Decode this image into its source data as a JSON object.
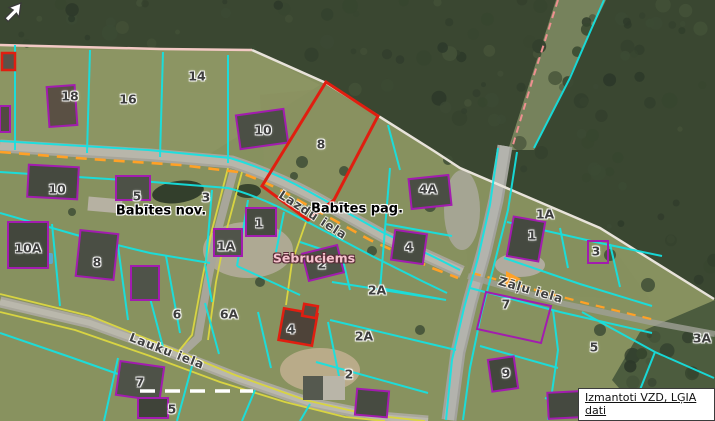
{
  "map": {
    "region_labels": {
      "municipality": "Babītes nov.",
      "parish": "Babītes pag.",
      "village": "Sēbruciems"
    },
    "streets": [
      {
        "name": "Lazdu iela"
      },
      {
        "name": "Zāļu iela"
      },
      {
        "name": "Lauku iela"
      }
    ],
    "parcels": [
      {
        "label": "18"
      },
      {
        "label": "16"
      },
      {
        "label": "14"
      },
      {
        "label": "10"
      },
      {
        "label": "8"
      },
      {
        "label": "10"
      },
      {
        "label": "5"
      },
      {
        "label": "3"
      },
      {
        "label": "4A"
      },
      {
        "label": "1A"
      },
      {
        "label": "10A"
      },
      {
        "label": "8"
      },
      {
        "label": "1"
      },
      {
        "label": "1A"
      },
      {
        "label": "2"
      },
      {
        "label": "4"
      },
      {
        "label": "1"
      },
      {
        "label": "3"
      },
      {
        "label": "2A"
      },
      {
        "label": "6"
      },
      {
        "label": "6A"
      },
      {
        "label": "4"
      },
      {
        "label": "2A"
      },
      {
        "label": "2"
      },
      {
        "label": "7"
      },
      {
        "label": "5"
      },
      {
        "label": "7"
      },
      {
        "label": "9"
      },
      {
        "label": "5"
      },
      {
        "label": "3A"
      }
    ],
    "selected_parcel": {
      "label": "8"
    },
    "attribution": {
      "text": "Izmantoti VZD, LĢIA dati"
    },
    "icons": [
      {
        "name": "ne-arrow-cursor"
      }
    ],
    "colors": {
      "parcel_boundary": "#14e3e3",
      "selected_parcel_outline": "#e01e10",
      "building_outline": "#a21caf",
      "road_centerline_dash": "#ffa126",
      "minor_road_edge": "#d8d442",
      "admin_boundary_pink": "#f2c9c4",
      "admin_boundary_white": "#e8e3da",
      "village_label_fill": "#f6c3ce"
    }
  }
}
